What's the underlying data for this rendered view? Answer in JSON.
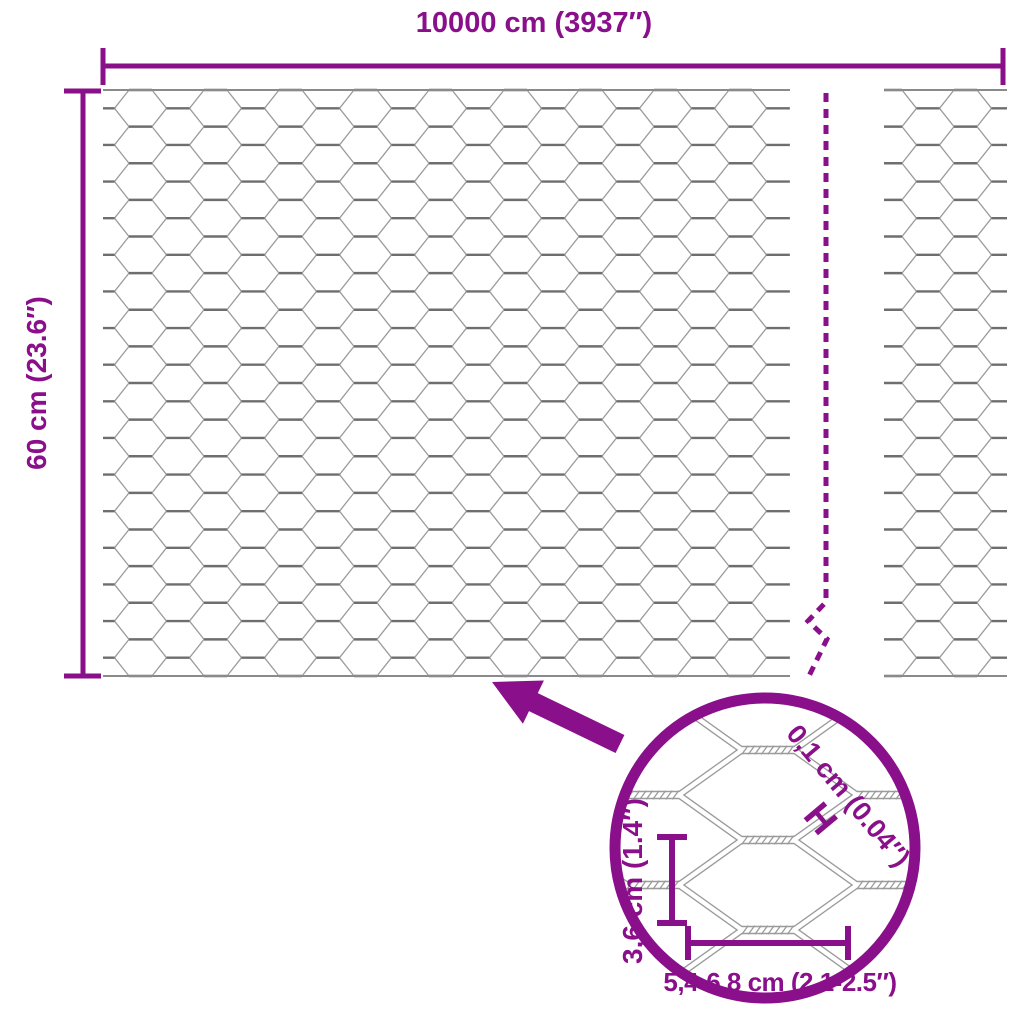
{
  "colors": {
    "accent": "#8A0F8A",
    "wire": "#9b9b9b",
    "twist": "#6e6e6e",
    "edge": "#8a8a8a",
    "background": "#ffffff"
  },
  "labels": {
    "roll_length": "10000 cm (3937″)",
    "roll_height": "60 cm (23.6″)",
    "wire_thickness": "0,1 cm (0.04″)",
    "wire_thickness_marker": "H",
    "mesh_height": "3,6 cm (1.4″)",
    "mesh_width": "5,4-6,8 cm (2.1-2.5″)"
  }
}
